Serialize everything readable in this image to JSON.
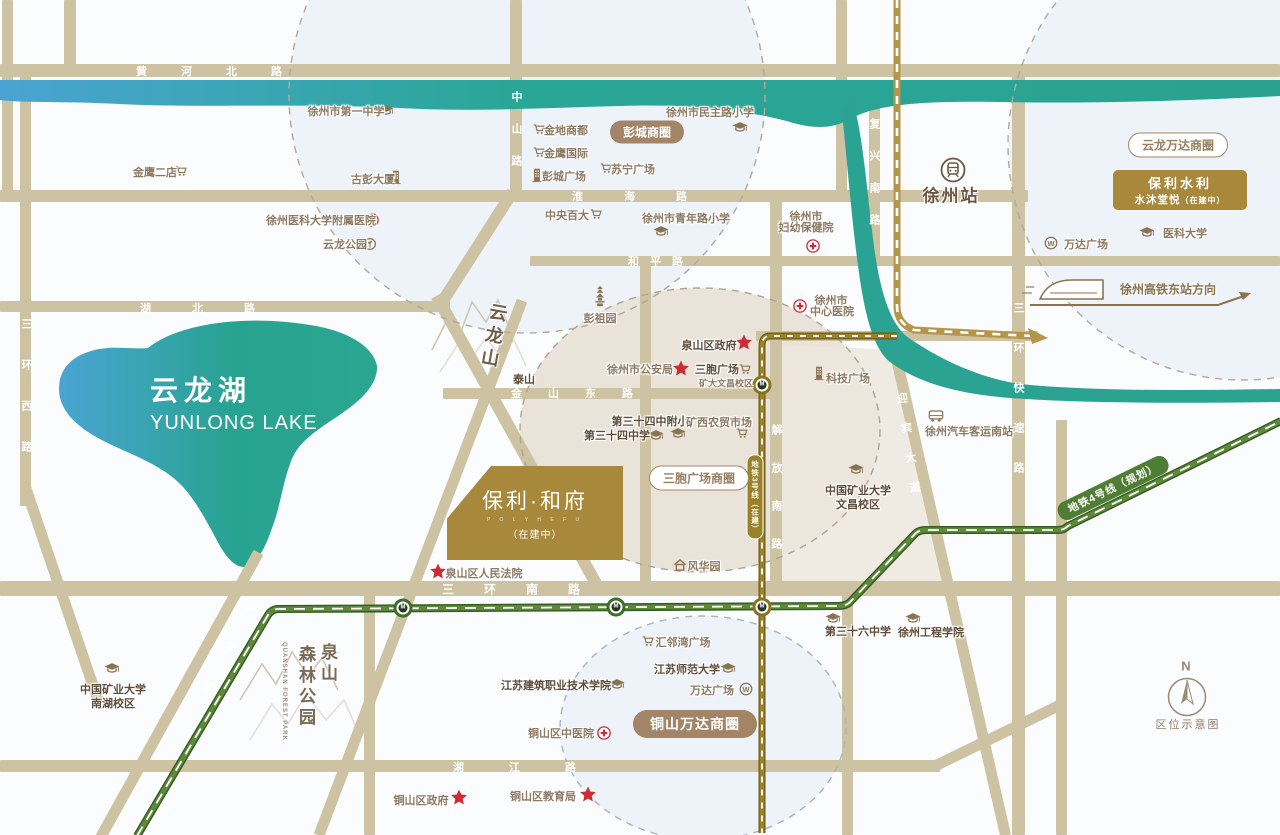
{
  "compass": {
    "n": "N",
    "caption": "区位示意图"
  },
  "lake": {
    "zh": "云龙湖",
    "en": "YUNLONG LAKE"
  },
  "mountains": {
    "yunlong": "云龙山",
    "quanshan_l1": "泉山",
    "quanshan_l2": "森林公园",
    "quanshan_en": "QUANSHAN FOREST PARK"
  },
  "station_xuzhou": "徐州站",
  "hsr": {
    "label": "徐州高铁东站方向"
  },
  "project": {
    "name": "保利·和府",
    "latin": "P O L Y  H E F U",
    "status": "（在建中）"
  },
  "poly_shuili": {
    "l1": "保利水利",
    "l2": "水沐堂悦",
    "l2s": "（在建中）"
  },
  "metro3_label": "地铁3号线（在建）",
  "metro4_label": "地铁4号线（规划）",
  "colors": {
    "road": "#cdc2a2",
    "lake_blue": "#4aa4d2",
    "lake_teal": "#27a391",
    "metro3": "#9b8226",
    "metro4": "#5c8a3a",
    "gold": "#a8893b",
    "badge_brown": "#a28566",
    "red": "#ce2b36"
  },
  "road_labels": [
    {
      "t": "黄河北路",
      "x": 226,
      "y": 71,
      "dir": "h",
      "ls": 34
    },
    {
      "t": "淮海路",
      "x": 650,
      "y": 196,
      "dir": "h",
      "ls": 41
    },
    {
      "t": "和平路",
      "x": 661,
      "y": 261,
      "dir": "h",
      "ls": 11
    },
    {
      "t": "湖北路",
      "x": 218,
      "y": 308,
      "dir": "h",
      "ls": 41
    },
    {
      "t": "金山东路",
      "x": 585,
      "y": 393,
      "dir": "h",
      "ls": 26
    },
    {
      "t": "三环南路",
      "x": 526,
      "y": 589,
      "dir": "h",
      "ls": 30,
      "fs": 12
    },
    {
      "t": "湘江路",
      "x": 537,
      "y": 767,
      "dir": "h",
      "ls": 45
    },
    {
      "t": "中山路",
      "x": 516,
      "y": 139,
      "dir": "v",
      "ls": 21
    },
    {
      "t": "复兴南路",
      "x": 874,
      "y": 182,
      "dir": "v",
      "ls": 21
    },
    {
      "t": "三环快速路",
      "x": 1018,
      "y": 402,
      "dir": "v",
      "ls": 29
    },
    {
      "t": "三环西路",
      "x": 26,
      "y": 400,
      "dir": "v",
      "ls": 30
    },
    {
      "t": "解放南路",
      "x": 776,
      "y": 500,
      "dir": "v",
      "ls": 27
    },
    {
      "t": "迎宾大道",
      "x": 909,
      "y": 452,
      "dir": "v",
      "ls": 19,
      "rot": -8
    },
    {
      "t": "大学路",
      "x": 221,
      "y": 661,
      "dir": "v",
      "ls": 33,
      "rot": 29
    }
  ],
  "stations": [
    {
      "x": 403,
      "y": 608,
      "c": "#3c6e2c"
    },
    {
      "x": 616,
      "y": 607,
      "c": "#3c6e2c"
    },
    {
      "x": 762,
      "y": 607,
      "c": "#8a7320"
    },
    {
      "x": 762,
      "y": 385,
      "c": "#8a7320"
    }
  ],
  "pois": [
    {
      "t": "徐州市第一中学",
      "x": 346,
      "y": 111,
      "icon": "school",
      "ix": 386,
      "iy": 110
    },
    {
      "t": "金鹰二店",
      "x": 155,
      "y": 172,
      "icon": "cart",
      "ix": 181,
      "iy": 171
    },
    {
      "t": "金地商都",
      "x": 566,
      "y": 130,
      "icon": "cart",
      "ix": 539,
      "iy": 129
    },
    {
      "t": "金鹰国际",
      "x": 566,
      "y": 153,
      "icon": "cart",
      "ix": 539,
      "iy": 152
    },
    {
      "t": "彭城广场",
      "x": 564,
      "y": 176,
      "icon": "building",
      "ix": 537,
      "iy": 175
    },
    {
      "t": "苏宁广场",
      "x": 633,
      "y": 169,
      "icon": "cart",
      "ix": 606,
      "iy": 168
    },
    {
      "t": "古彭大厦",
      "x": 373,
      "y": 179,
      "icon": "building",
      "ix": 396,
      "iy": 177
    },
    {
      "t": "徐州医科大学附属医院",
      "x": 321,
      "y": 220,
      "icon": "hospital",
      "ix": 372,
      "iy": 220
    },
    {
      "t": "云龙公园",
      "x": 345,
      "y": 244,
      "icon": "park",
      "ix": 370,
      "iy": 244
    },
    {
      "t": "徐州市民主路小学",
      "x": 710,
      "y": 112,
      "icon": "school",
      "ix": 740,
      "iy": 127
    },
    {
      "t": "中央百大",
      "x": 567,
      "y": 215,
      "icon": "cart",
      "ix": 596,
      "iy": 214
    },
    {
      "t": "徐州市青年路小学",
      "x": 686,
      "y": 218,
      "icon": "school",
      "ix": 661,
      "iy": 231
    },
    {
      "t": "徐州市",
      "x": 806,
      "y": 216,
      "l2": "妇幼保健院",
      "l2y": 227,
      "icon": "hospital",
      "ix": 813,
      "iy": 246
    },
    {
      "t": "徐州市",
      "x": 831,
      "y": 300,
      "l2": "中心医院",
      "l2x": 832,
      "l2y": 311,
      "icon": "hospital",
      "ix": 800,
      "iy": 306
    },
    {
      "t": "彭祖园",
      "x": 600,
      "y": 318,
      "icon": "pagoda",
      "ix": 600,
      "iy": 296
    },
    {
      "t": "泉山区政府",
      "x": 709,
      "y": 345,
      "b": 1,
      "icon": "star",
      "ix": 744,
      "iy": 342
    },
    {
      "t": "徐州市公安局",
      "x": 640,
      "y": 369,
      "icon": "star",
      "ix": 681,
      "iy": 368
    },
    {
      "t": "三胞广场",
      "x": 717,
      "y": 369,
      "b": 1,
      "icon": "cart",
      "ix": 745,
      "iy": 369
    },
    {
      "t": "矿大文昌校区",
      "x": 726,
      "y": 383,
      "sm": 1
    },
    {
      "t": "科技广场",
      "x": 848,
      "y": 378,
      "icon": "building",
      "ix": 819,
      "iy": 373
    },
    {
      "t": "泰山",
      "x": 524,
      "y": 379,
      "b": 1
    },
    {
      "t": "第三十四中附小",
      "x": 650,
      "y": 421,
      "b": 1
    },
    {
      "t": "第三十四中学",
      "x": 617,
      "y": 435,
      "b": 1
    },
    {
      "icon": "school",
      "ix": 656,
      "iy": 435
    },
    {
      "icon": "school",
      "ix": 678,
      "iy": 433
    },
    {
      "t": "矿西农贸市场",
      "x": 719,
      "y": 422,
      "icon": "cart",
      "ix": 742,
      "iy": 433
    },
    {
      "t": "中国矿业大学",
      "x": 858,
      "y": 490,
      "b": 1,
      "l2": "文昌校区",
      "l2y": 504,
      "icon": "school",
      "ix": 856,
      "iy": 469
    },
    {
      "t": "风华园",
      "x": 704,
      "y": 566,
      "icon": "house",
      "ix": 680,
      "iy": 565
    },
    {
      "t": "泉山区人民法院",
      "x": 484,
      "y": 573,
      "icon": "star",
      "ix": 438,
      "iy": 571
    },
    {
      "t": "汇邻湾广场",
      "x": 683,
      "y": 642,
      "icon": "cart",
      "ix": 648,
      "iy": 641
    },
    {
      "t": "江苏师范大学",
      "x": 687,
      "y": 669,
      "b": 1,
      "icon": "school",
      "ix": 728,
      "iy": 668
    },
    {
      "t": "万达广场",
      "x": 712,
      "y": 690,
      "icon": "wanda",
      "ix": 746,
      "iy": 689
    },
    {
      "t": "江苏建筑职业技术学院",
      "x": 556,
      "y": 685,
      "b": 1,
      "icon": "school",
      "ix": 617,
      "iy": 684
    },
    {
      "t": "铜山区中医院",
      "x": 561,
      "y": 733,
      "icon": "hospital",
      "ix": 604,
      "iy": 733
    },
    {
      "t": "铜山区政府",
      "x": 421,
      "y": 800,
      "icon": "star",
      "ix": 459,
      "iy": 797
    },
    {
      "t": "铜山区教育局",
      "x": 543,
      "y": 796,
      "icon": "star",
      "ix": 588,
      "iy": 794
    },
    {
      "t": "第三十六中学",
      "x": 858,
      "y": 631,
      "b": 1,
      "icon": "school",
      "ix": 833,
      "iy": 618
    },
    {
      "t": "徐州工程学院",
      "x": 931,
      "y": 632,
      "b": 1,
      "icon": "school",
      "ix": 913,
      "iy": 618
    },
    {
      "t": "中国矿业大学",
      "x": 113,
      "y": 689,
      "b": 1,
      "l2": "南湖校区",
      "l2y": 703,
      "icon": "school",
      "ix": 112,
      "iy": 668
    },
    {
      "t": "医科大学",
      "x": 1185,
      "y": 233,
      "icon": "school",
      "ix": 1147,
      "iy": 232
    },
    {
      "t": "万达广场",
      "x": 1086,
      "y": 244,
      "icon": "wanda",
      "ix": 1051,
      "iy": 243
    },
    {
      "t": "徐州汽车客运南站",
      "x": 969,
      "y": 431,
      "icon": "bus",
      "ix": 936,
      "iy": 416
    },
    {
      "t": "彭城商圈",
      "x": 647,
      "y": 132,
      "pill": "f"
    },
    {
      "t": "云龙万达商圈",
      "x": 1178,
      "y": 145,
      "pill": "o"
    },
    {
      "t": "三胞广场商圈",
      "x": 699,
      "y": 478,
      "pill": "o"
    },
    {
      "t": "铜山万达商圈",
      "x": 695,
      "y": 724,
      "pill": "F"
    }
  ]
}
